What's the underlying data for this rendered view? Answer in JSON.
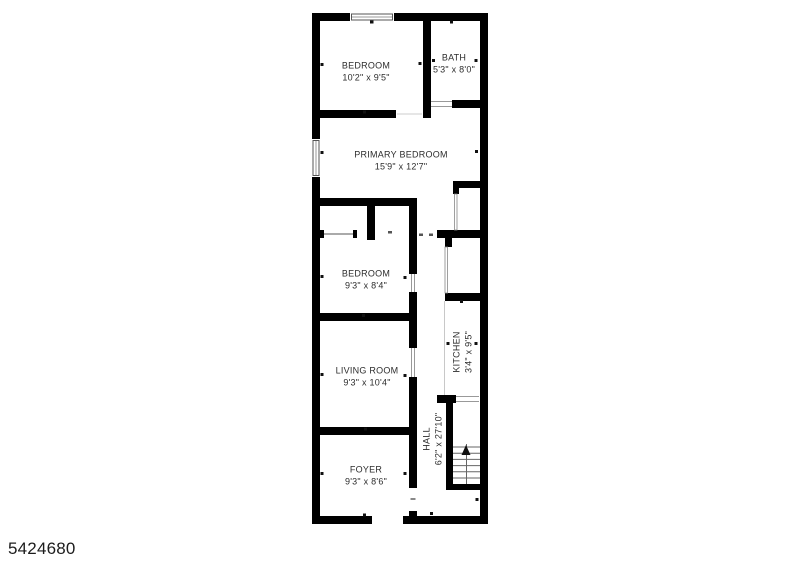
{
  "page": {
    "photo_id": "5424680"
  },
  "floorplan": {
    "rooms": [
      {
        "name": "BEDROOM",
        "dims": "10'2\" x 9'5\""
      },
      {
        "name": "BATH",
        "dims": "5'3\" x 8'0\""
      },
      {
        "name": "PRIMARY BEDROOM",
        "dims": "15'9\" x 12'7\""
      },
      {
        "name": "BEDROOM",
        "dims": "9'3\" x 8'4\""
      },
      {
        "name": "LIVING ROOM",
        "dims": "9'3\" x 10'4\""
      },
      {
        "name": "KITCHEN",
        "dims": "3'4\" x 9'5\""
      },
      {
        "name": "HALL",
        "dims": "6'2\" x 27'10\""
      },
      {
        "name": "FOYER",
        "dims": "9'3\" x 8'6\""
      }
    ],
    "stairs": {
      "direction": "up"
    }
  },
  "colors": {
    "wall": "#000000",
    "background": "#ffffff",
    "label_text": "#2d2d2d"
  }
}
